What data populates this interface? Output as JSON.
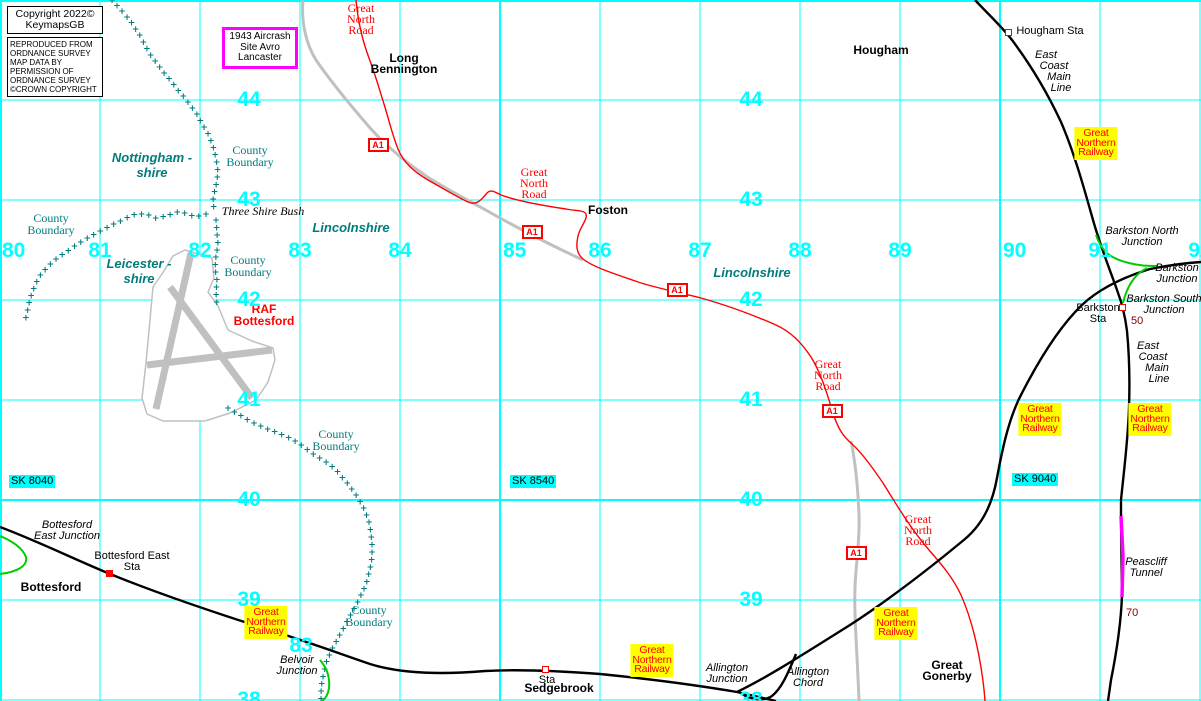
{
  "boxes": {
    "copyright_lines": [
      "Copyright 2022©",
      "KeymapsGB"
    ],
    "os_lines": [
      "REPRODUCED FROM",
      "ORDNANCE SURVEY",
      "MAP DATA BY",
      "PERMISSION OF",
      "ORDNANCE SURVEY",
      "©CROWN COPYRIGHT"
    ],
    "crash_lines": [
      "1943",
      "Aircrash Site",
      "Avro",
      "Lancaster"
    ]
  },
  "colors": {
    "grid": "#00ffff",
    "boundary": "#007c7c",
    "road": "#ff0000",
    "old_road": "#c0c0c0",
    "railway": "#000000",
    "chord": "#00cc00",
    "tunnel": "#ff00ff",
    "highlight": "#ffff00",
    "milepost": "#800000"
  },
  "grid": {
    "v_num_y": 241,
    "h_num_cols": [
      249,
      751
    ],
    "verticals": [
      {
        "x": 1,
        "label": "80",
        "thick": true,
        "num_align": "left",
        "num_x": 2
      },
      {
        "x": 100,
        "label": "81"
      },
      {
        "x": 200,
        "label": "82"
      },
      {
        "x": 300,
        "label": "83"
      },
      {
        "x": 400,
        "label": "84"
      },
      {
        "x": 500,
        "label": "85",
        "thick": true,
        "num_align": "left",
        "num_x": 503
      },
      {
        "x": 600,
        "label": "86"
      },
      {
        "x": 700,
        "label": "87"
      },
      {
        "x": 800,
        "label": "88"
      },
      {
        "x": 900,
        "label": "89"
      },
      {
        "x": 1000,
        "label": "90",
        "thick": true,
        "num_align": "left",
        "num_x": 1003
      },
      {
        "x": 1100,
        "label": "91"
      },
      {
        "x": 1200,
        "label": "92"
      }
    ],
    "horizontals": [
      {
        "y": 1,
        "label": "",
        "thick": true
      },
      {
        "y": 100,
        "label": "44"
      },
      {
        "y": 200,
        "label": "43"
      },
      {
        "y": 300,
        "label": "42"
      },
      {
        "y": 400,
        "label": "41"
      },
      {
        "y": 500,
        "label": "40",
        "thick": true
      },
      {
        "y": 600,
        "label": "39"
      },
      {
        "y": 700,
        "label": "38"
      }
    ]
  },
  "labels": [
    {
      "name": "road-label-great-north-road-1",
      "cls": "roadname",
      "cx": 361,
      "y": 3,
      "lines": [
        "Great",
        "North",
        "Road"
      ]
    },
    {
      "name": "road-label-great-north-road-2",
      "cls": "roadname",
      "cx": 534,
      "y": 167,
      "lines": [
        "Great",
        "North",
        "Road"
      ]
    },
    {
      "name": "road-label-great-north-road-3",
      "cls": "roadname",
      "cx": 828,
      "y": 359,
      "lines": [
        "Great",
        "North",
        "Road"
      ]
    },
    {
      "name": "road-label-great-north-road-4",
      "cls": "roadname",
      "cx": 918,
      "y": 514,
      "lines": [
        "Great",
        "North",
        "Road"
      ]
    },
    {
      "name": "place-long-bennington",
      "cls": "place",
      "cx": 404,
      "y": 53,
      "lines": [
        "Long",
        "Bennington"
      ]
    },
    {
      "name": "place-hougham",
      "cls": "place",
      "cx": 881,
      "y": 45,
      "lines": [
        "Hougham"
      ]
    },
    {
      "name": "place-foston",
      "cls": "place",
      "cx": 608,
      "y": 205,
      "lines": [
        "Foston"
      ]
    },
    {
      "name": "place-bottesford",
      "cls": "place",
      "cx": 51,
      "y": 582,
      "lines": [
        "Bottesford"
      ]
    },
    {
      "name": "place-sedgebrook",
      "cls": "place",
      "cx": 559,
      "y": 683,
      "lines": [
        "Sedgebrook"
      ]
    },
    {
      "name": "place-great-gonerby",
      "cls": "place",
      "cx": 947,
      "y": 660,
      "lines": [
        "Great",
        "Gonerby"
      ]
    },
    {
      "name": "place-raf-bottesford",
      "cls": "raf",
      "cx": 264,
      "y": 304,
      "lines": [
        "RAF",
        "Bottesford"
      ]
    },
    {
      "name": "station-label-hougham-sta",
      "cls": "sta",
      "cx": 1050,
      "y": 26,
      "lines": [
        "Hougham Sta"
      ]
    },
    {
      "name": "station-label-bottesford-east-sta",
      "cls": "sta",
      "cx": 132,
      "y": 551,
      "lines": [
        "Bottesford East",
        "Sta"
      ]
    },
    {
      "name": "station-label-sedgebrook-sta",
      "cls": "sta",
      "cx": 547,
      "y": 675,
      "lines": [
        "Sta"
      ]
    },
    {
      "name": "station-label-barkston-sta",
      "cls": "sta",
      "cx": 1098,
      "y": 303,
      "lines": [
        "Barkston",
        "Sta"
      ]
    },
    {
      "name": "junction-label-bottesford-east",
      "cls": "junction",
      "cx": 67,
      "y": 520,
      "lines": [
        "Bottesford",
        "East Junction"
      ]
    },
    {
      "name": "junction-label-belvoir",
      "cls": "junction",
      "cx": 297,
      "y": 655,
      "lines": [
        "Belvoir",
        "Junction"
      ]
    },
    {
      "name": "junction-label-allington",
      "cls": "junction",
      "cx": 727,
      "y": 663,
      "lines": [
        "Allington",
        "Junction"
      ]
    },
    {
      "name": "label-allington-chord",
      "cls": "junction",
      "cx": 808,
      "y": 667,
      "lines": [
        "Allington",
        "Chord"
      ]
    },
    {
      "name": "junction-label-barkston-north",
      "cls": "junction",
      "cx": 1142,
      "y": 226,
      "lines": [
        "Barkston North",
        "Junction"
      ]
    },
    {
      "name": "junction-label-barkston",
      "cls": "junction",
      "cx": 1177,
      "y": 263,
      "lines": [
        "Barkston",
        "Junction"
      ]
    },
    {
      "name": "junction-label-barkston-south",
      "cls": "junction",
      "cx": 1164,
      "y": 294,
      "lines": [
        "Barkston South",
        "Junction"
      ]
    },
    {
      "name": "railway-label-ecml-north-1",
      "cls": "junction",
      "cx": 1046,
      "y": 50,
      "lines": [
        "East"
      ]
    },
    {
      "name": "railway-label-ecml-north-2",
      "cls": "junction",
      "cx": 1054,
      "y": 61,
      "lines": [
        "Coast"
      ]
    },
    {
      "name": "railway-label-ecml-north-3",
      "cls": "junction",
      "cx": 1059,
      "y": 72,
      "lines": [
        "Main"
      ]
    },
    {
      "name": "railway-label-ecml-north-4",
      "cls": "junction",
      "cx": 1061,
      "y": 83,
      "lines": [
        "Line"
      ]
    },
    {
      "name": "railway-label-ecml-south-1",
      "cls": "junction",
      "cx": 1148,
      "y": 341,
      "lines": [
        "East"
      ]
    },
    {
      "name": "railway-label-ecml-south-2",
      "cls": "junction",
      "cx": 1153,
      "y": 352,
      "lines": [
        "Coast"
      ]
    },
    {
      "name": "railway-label-ecml-south-3",
      "cls": "junction",
      "cx": 1157,
      "y": 363,
      "lines": [
        "Main"
      ]
    },
    {
      "name": "railway-label-ecml-south-4",
      "cls": "junction",
      "cx": 1159,
      "y": 374,
      "lines": [
        "Line"
      ]
    },
    {
      "name": "label-peascliff-tunnel",
      "cls": "junction",
      "cx": 1146,
      "y": 557,
      "lines": [
        "Peascliff",
        "Tunnel"
      ]
    },
    {
      "name": "label-three-shire-bush",
      "cls": "tsb",
      "cx": 263,
      "y": 206,
      "lines": [
        "Three Shire Bush"
      ]
    },
    {
      "name": "county-label-nottinghamshire",
      "cls": "shire",
      "cx": 152,
      "y": 150,
      "lines": [
        "Nottingham -",
        "shire"
      ]
    },
    {
      "name": "county-label-leicestershire",
      "cls": "shire",
      "cx": 139,
      "y": 256,
      "lines": [
        "Leicester -",
        "shire"
      ]
    },
    {
      "name": "county-label-lincolnshire-1",
      "cls": "shire",
      "cx": 351,
      "y": 220,
      "lines": [
        "Lincolnshire"
      ]
    },
    {
      "name": "county-label-lincolnshire-2",
      "cls": "shire",
      "cx": 752,
      "y": 265,
      "lines": [
        "Lincolnshire"
      ]
    },
    {
      "name": "county-boundary-label-1",
      "cls": "county",
      "cx": 250,
      "y": 145,
      "lines": [
        "County",
        "Boundary"
      ]
    },
    {
      "name": "county-boundary-label-2",
      "cls": "county",
      "cx": 51,
      "y": 213,
      "lines": [
        "County",
        "Boundary"
      ]
    },
    {
      "name": "county-boundary-label-3",
      "cls": "county",
      "cx": 248,
      "y": 255,
      "lines": [
        "County",
        "Boundary"
      ]
    },
    {
      "name": "county-boundary-label-4",
      "cls": "county",
      "cx": 336,
      "y": 429,
      "lines": [
        "County",
        "Boundary"
      ]
    },
    {
      "name": "county-boundary-label-5",
      "cls": "county",
      "cx": 369,
      "y": 605,
      "lines": [
        "County",
        "Boundary"
      ]
    },
    {
      "name": "milepost-50",
      "cls": "maroon",
      "x": 1131,
      "y": 316,
      "lines": [
        "50"
      ]
    },
    {
      "name": "milepost-70",
      "cls": "maroon",
      "x": 1126,
      "y": 608,
      "lines": [
        "70"
      ]
    },
    {
      "name": "grid-number-83-south",
      "cls": "gridnum",
      "cx": 301,
      "y": 636,
      "lines": [
        "83"
      ]
    }
  ],
  "a1_text": "A1",
  "a1_badges": [
    {
      "cx": 378,
      "cy": 145
    },
    {
      "cx": 532,
      "cy": 232
    },
    {
      "cx": 677,
      "cy": 290
    },
    {
      "cx": 832,
      "cy": 411
    },
    {
      "cx": 856,
      "cy": 553
    }
  ],
  "gnr_lines": [
    "Great",
    "Northern",
    "Railway"
  ],
  "gnr_boxes": [
    {
      "cx": 1096,
      "y": 127
    },
    {
      "cx": 1040,
      "y": 403
    },
    {
      "cx": 1150,
      "y": 403
    },
    {
      "cx": 266,
      "y": 606
    },
    {
      "cx": 652,
      "y": 644
    },
    {
      "cx": 896,
      "y": 607
    }
  ],
  "sk_refs": [
    {
      "text": "SK 8040",
      "x": 9,
      "y": 475
    },
    {
      "text": "SK 8540",
      "x": 510,
      "y": 475
    },
    {
      "text": "SK 9040",
      "x": 1012,
      "y": 473
    }
  ],
  "stations": [
    {
      "name": "hougham-station-marker",
      "x": 1008,
      "y": 32,
      "filled": false
    },
    {
      "name": "bottesford-east-station-marker",
      "x": 109,
      "y": 573,
      "filled": true
    },
    {
      "name": "sedgebrook-station-marker",
      "x": 545,
      "y": 669,
      "filled": false
    },
    {
      "name": "barkston-station-marker",
      "x": 1122,
      "y": 307,
      "filled": false
    }
  ],
  "geometry": {
    "gray_roads": [
      "M303,0 C301,22 306,44 316,60 C331,82 351,106 371,129 C391,151 409,164 426,176 C446,189 466,199 491,213 C516,227 546,243 583,260",
      "M851,441 C856,465 858,490 859,515 C860,540 856,562 855,587 C854,617 857,647 859,701"
    ],
    "red_road": "M356,0 C358,22 363,42 369,58 C375,74 379,88 384,104 C389,120 392,134 398,149 C404,163 413,171 428,180 C444,189 457,197 468,202 C477,206 482,199 487,193 C491,189 495,192 501,195 C517,201 546,206 566,209 C576,211 584,210 586,214 C588,219 580,227 578,236 C576,245 576,253 583,259 C593,267 612,273 641,283 C661,289 681,293 701,298 C726,305 751,314 776,325 C791,332 801,342 811,357 C819,370 825,386 832,410 C838,430 844,437 852,444 C862,453 872,467 883,483 C896,504 911,529 929,550 C943,566 953,578 961,595 C969,613 975,635 979,656 C982,672 984,686 985,701",
    "railways": [
      "M0,527 C40,542 80,562 115,576 C160,594 210,611 260,627 C300,639 335,652 370,664 C405,675 450,674 485,671 C520,669 560,671 600,674 C640,678 690,684 737,692 L776,701",
      "M737,692 C770,676 810,650 850,625 C890,599 930,568 965,539 C985,522 993,500 997,478 C1003,445 1010,415 1022,393 C1040,358 1060,326 1082,305 C1100,288 1124,277 1150,269 C1170,265 1185,263 1201,262",
      "M796,654 C788,673 782,688 772,696 C763,702 750,699 742,694",
      "M975,0 C992,18 1003,28 1012,40 C1030,64 1047,92 1061,122 C1074,152 1084,188 1093,220 C1101,248 1110,270 1117,290 C1122,303 1125,315 1127,331 C1129,352 1130,378 1129,408 C1128,440 1124,470 1121,500 L1121,517 L1122,595 C1121,625 1116,655 1111,680 L1108,701"
    ],
    "green_chords": [
      "M1096,235 C1101,251 1111,259 1129,263 C1140,266 1150,266 1158,266",
      "M1147,268 C1135,274 1127,286 1123,303",
      "M0,536 C13,541 23,549 26,557 C28,566 17,572 0,574",
      "M320,660 C327,668 330,678 329,688 C328,695 325,699 322,701"
    ],
    "tunnel": "M1121,516 L1123,556 L1122,597",
    "airfield": {
      "outline": "M185,250 L212,258 L214,278 L208,292 L218,306 L228,330 L252,341 L273,348 L275,360 L268,382 L256,400 L230,413 L205,421 L163,421 L147,414 L142,398 L146,363 L153,287 L164,271 L173,256 Z",
      "runways": [
        [
          191,
          253,
          156,
          409
        ],
        [
          170,
          287,
          252,
          398
        ],
        [
          147,
          365,
          272,
          350
        ]
      ]
    },
    "boundaries": [
      [
        [
          112,
          0
        ],
        [
          121,
          10
        ],
        [
          129,
          19
        ],
        [
          135,
          28
        ],
        [
          141,
          37
        ],
        [
          146,
          47
        ],
        [
          152,
          57
        ],
        [
          159,
          66
        ],
        [
          165,
          74
        ],
        [
          172,
          82
        ],
        [
          178,
          90
        ],
        [
          185,
          98
        ],
        [
          191,
          106
        ],
        [
          197,
          114
        ],
        [
          202,
          124
        ],
        [
          209,
          135
        ],
        [
          213,
          146
        ],
        [
          216,
          158
        ],
        [
          218,
          172
        ],
        [
          216,
          185
        ],
        [
          213,
          198
        ],
        [
          214,
          210
        ]
      ],
      [
        [
          206,
          214
        ],
        [
          196,
          217
        ],
        [
          186,
          213
        ],
        [
          176,
          212
        ],
        [
          166,
          216
        ],
        [
          156,
          218
        ],
        [
          146,
          214
        ],
        [
          136,
          214
        ],
        [
          126,
          218
        ],
        [
          116,
          223
        ],
        [
          106,
          228
        ],
        [
          96,
          233
        ],
        [
          86,
          239
        ],
        [
          76,
          245
        ],
        [
          66,
          252
        ],
        [
          56,
          259
        ],
        [
          48,
          266
        ],
        [
          41,
          274
        ],
        [
          36,
          283
        ],
        [
          32,
          293
        ],
        [
          29,
          303
        ],
        [
          27,
          313
        ],
        [
          25,
          321
        ]
      ],
      [
        [
          216,
          220
        ],
        [
          217,
          232
        ],
        [
          218,
          244
        ],
        [
          216,
          256
        ],
        [
          215,
          268
        ],
        [
          217,
          280
        ],
        [
          216,
          292
        ],
        [
          217,
          304
        ]
      ],
      [
        [
          228,
          408
        ],
        [
          238,
          414
        ],
        [
          248,
          420
        ],
        [
          258,
          425
        ],
        [
          268,
          429
        ],
        [
          278,
          433
        ],
        [
          288,
          437
        ],
        [
          297,
          442
        ],
        [
          305,
          448
        ],
        [
          313,
          454
        ],
        [
          321,
          459
        ],
        [
          329,
          464
        ],
        [
          336,
          470
        ],
        [
          342,
          477
        ],
        [
          348,
          484
        ],
        [
          354,
          492
        ],
        [
          360,
          501
        ],
        [
          365,
          511
        ],
        [
          369,
          522
        ],
        [
          371,
          533
        ],
        [
          372,
          545
        ],
        [
          372,
          557
        ],
        [
          370,
          569
        ],
        [
          367,
          581
        ],
        [
          362,
          593
        ],
        [
          356,
          605
        ],
        [
          350,
          616
        ],
        [
          344,
          627
        ],
        [
          338,
          638
        ],
        [
          332,
          649
        ],
        [
          327,
          660
        ],
        [
          324,
          671
        ],
        [
          322,
          682
        ],
        [
          321,
          693
        ],
        [
          321,
          700
        ]
      ]
    ]
  }
}
